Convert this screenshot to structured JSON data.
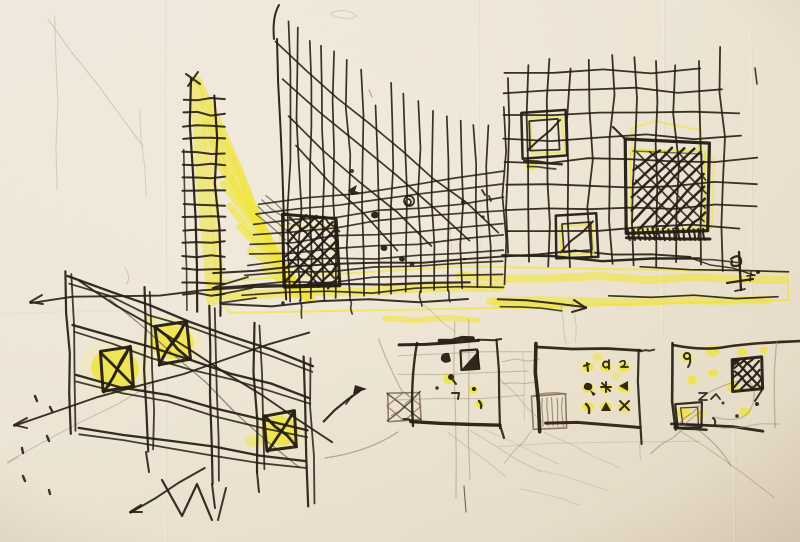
{
  "artwork": {
    "title": "Architectural concept sketches — black ink and yellow marker on cream paper",
    "panels": [
      {
        "id": "facade-perspective",
        "label": "Perspective sketch of tall slatted facade with yellow light rays and hatched opening"
      },
      {
        "id": "grid-plan",
        "label": "Hand-drawn grid plan with three yellow hatched square openings"
      },
      {
        "id": "screen-wall",
        "label": "Perspective screen wall with three crossed yellow openings and arrows"
      },
      {
        "id": "plan-study-1",
        "label": "Small plan study with hatched annex and scattered marks"
      },
      {
        "id": "plan-study-2",
        "label": "Small plan study with three-by-three grid of yellow dots"
      },
      {
        "id": "plan-study-3",
        "label": "Small plan study with dark hatched block and scattered yellow dots"
      }
    ],
    "signature": {
      "description": "artist monogram below grid plan, right side"
    }
  },
  "colors": {
    "paper": "#f3ecdf",
    "paper_mid": "#efe7d7",
    "paper_edge": "#e6dbc6",
    "ink": "#241c12",
    "highlighter": "#f1e73a",
    "highlighter_soft": "#f6efa0",
    "pencil": "#a09179",
    "sepia": "#82684c",
    "red_pencil": "#b5654a",
    "crease_light": "#ffffff",
    "crease_dark": "#b9a990"
  }
}
